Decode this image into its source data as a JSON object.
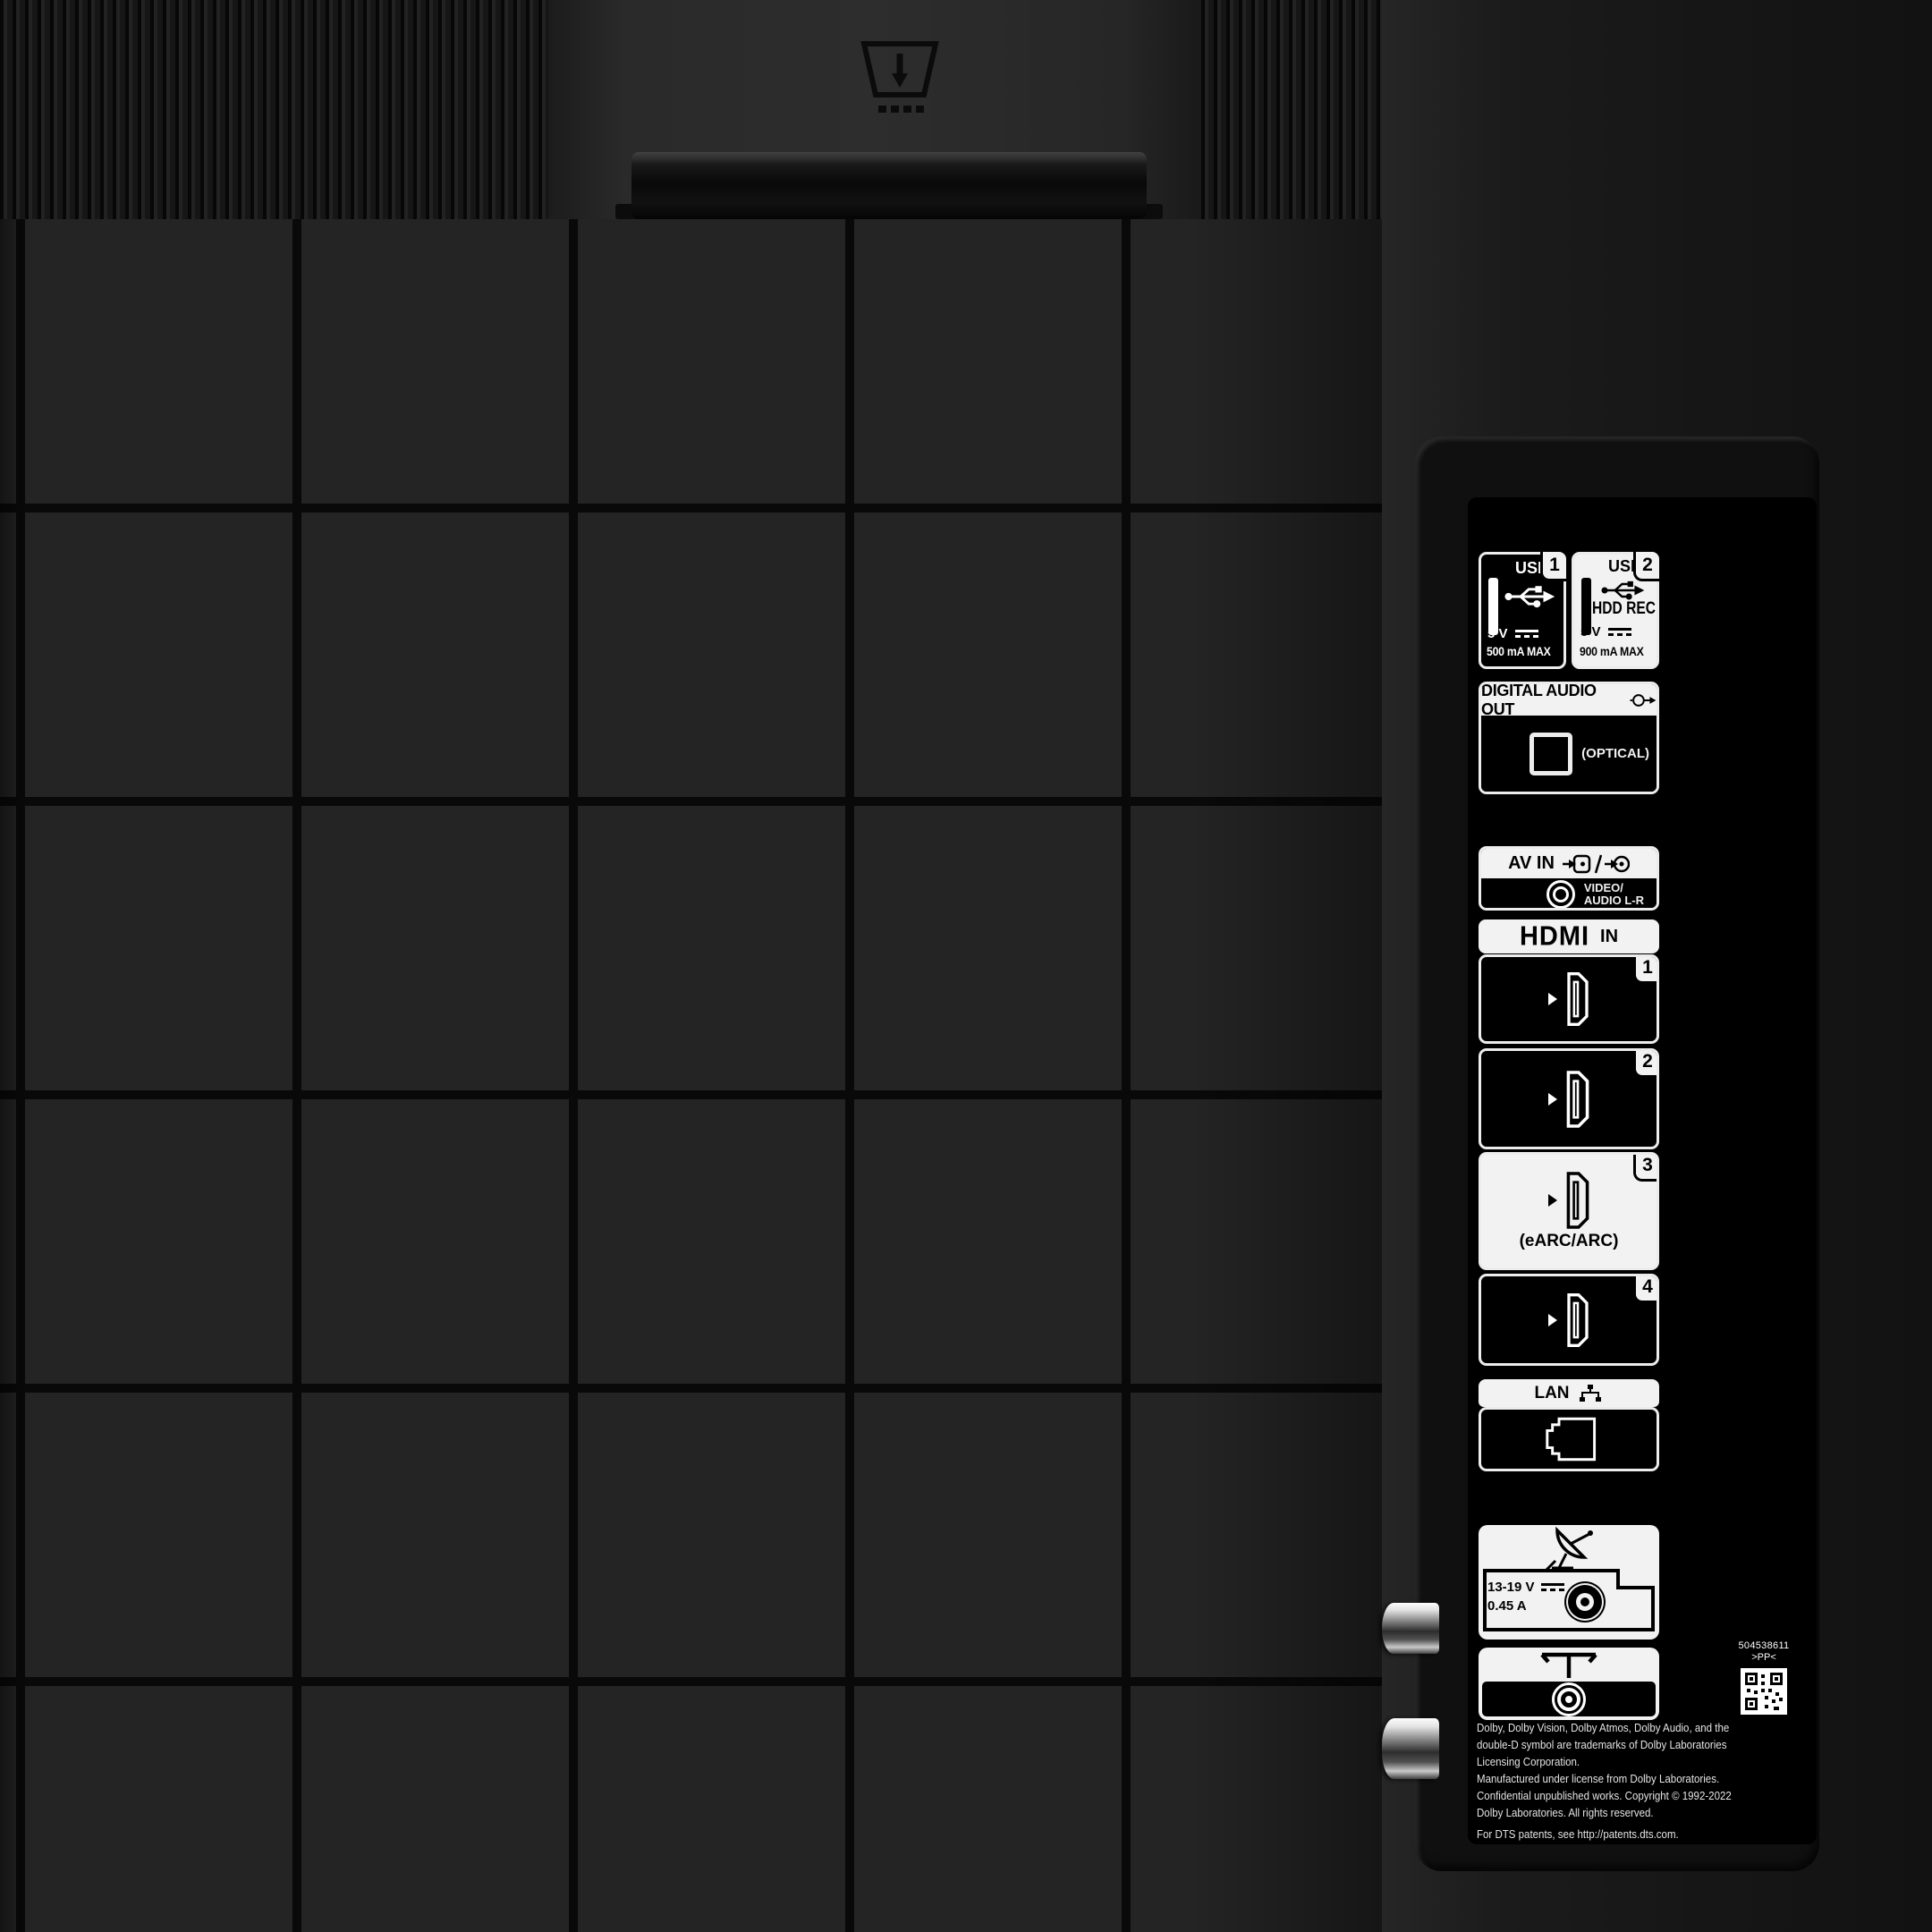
{
  "photo": {
    "subject": "TV rear connection panel"
  },
  "usb": {
    "port1": {
      "label": "USB",
      "number": "1",
      "voltage": "5 V",
      "current": "500 mA MAX"
    },
    "port2": {
      "label": "USB",
      "number": "2",
      "mode": "HDD REC",
      "voltage": "5 V",
      "current": "900 mA MAX"
    }
  },
  "digital_audio_out": {
    "label": "DIGITAL AUDIO OUT",
    "port": "(OPTICAL)"
  },
  "av_in": {
    "label": "AV IN",
    "line1": "VIDEO/",
    "line2": "AUDIO L-R"
  },
  "hdmi": {
    "logo": "HDMI",
    "suffix": "IN",
    "ports": [
      {
        "number": "1",
        "sublabel": ""
      },
      {
        "number": "2",
        "sublabel": ""
      },
      {
        "number": "3",
        "sublabel": "(eARC/ARC)"
      },
      {
        "number": "4",
        "sublabel": ""
      }
    ]
  },
  "lan": {
    "label": "LAN"
  },
  "satellite": {
    "voltage": "13-19 V",
    "current": "0.45 A"
  },
  "serial": {
    "number": "504538611",
    "code": "&gt;PP&lt;"
  },
  "legal": {
    "line1": "Dolby, Dolby Vision, Dolby Atmos, Dolby Audio, and the",
    "line2": "double-D symbol are trademarks of Dolby Laboratories",
    "line3": "Licensing Corporation.",
    "line4": "Manufactured under license from Dolby Laboratories.",
    "line5": "Confidential unpublished works. Copyright © 1992-2022",
    "line6": "Dolby Laboratories. All rights reserved.",
    "line7": "For DTS patents, see http://patents.dts.com."
  }
}
